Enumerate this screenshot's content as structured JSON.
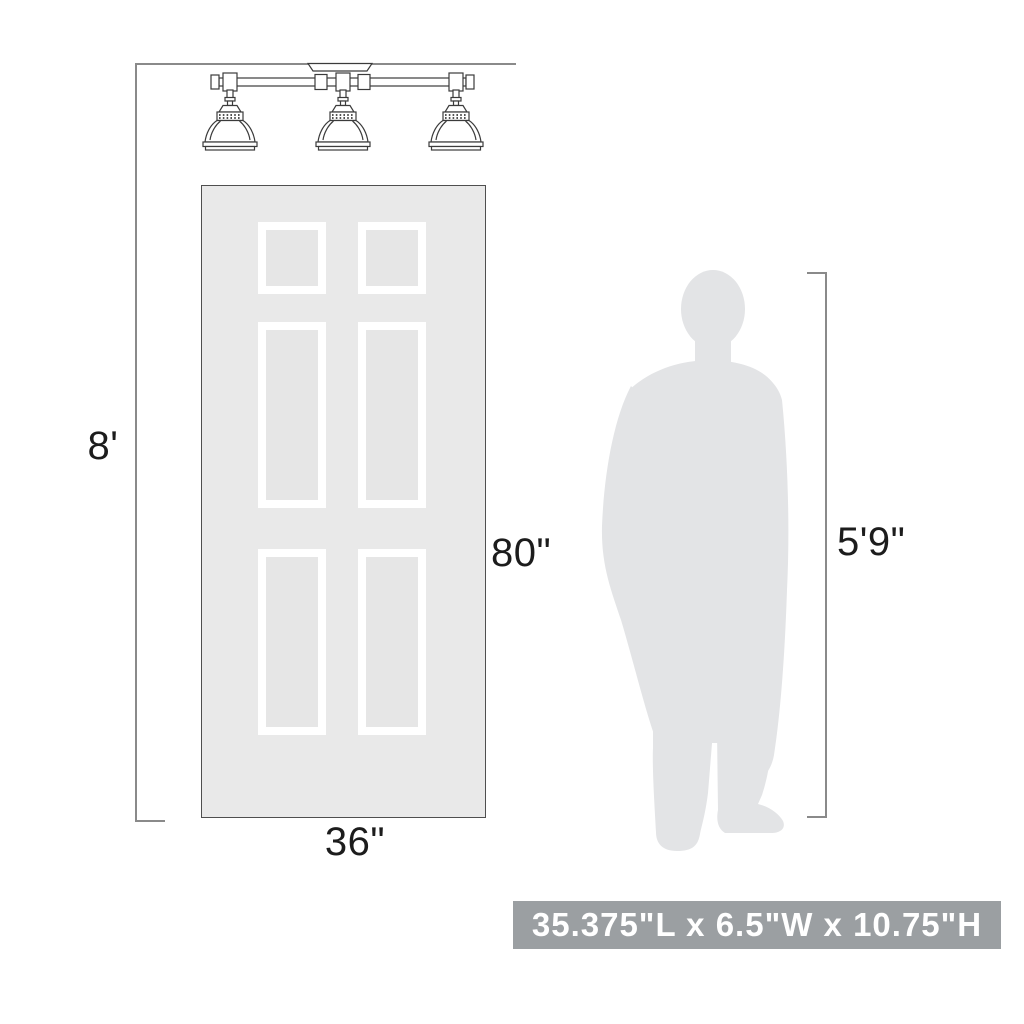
{
  "dimensions": {
    "ceiling_height": "8'",
    "door_height": "80\"",
    "door_width": "36\"",
    "person_height": "5'9\""
  },
  "banner": {
    "product_size_text": "35.375\"L x 6.5\"W x 10.75\"H"
  },
  "illustrations": {
    "fixture": "three-light semi-flush vanity fixture line drawing",
    "door": "six-panel door",
    "person": "standing man silhouette"
  },
  "colors": {
    "silhouette_fill": "#e3e4e6",
    "door_fill": "#e9e9e9",
    "panel_fill": "#e6e6e6",
    "panel_frame": "#ffffff",
    "dimension_line": "#8a8a8a",
    "line_art": "#3b3b3b",
    "label_text": "#1c1c1c",
    "banner_bg": "#9b9fa2",
    "banner_text": "#ffffff"
  }
}
